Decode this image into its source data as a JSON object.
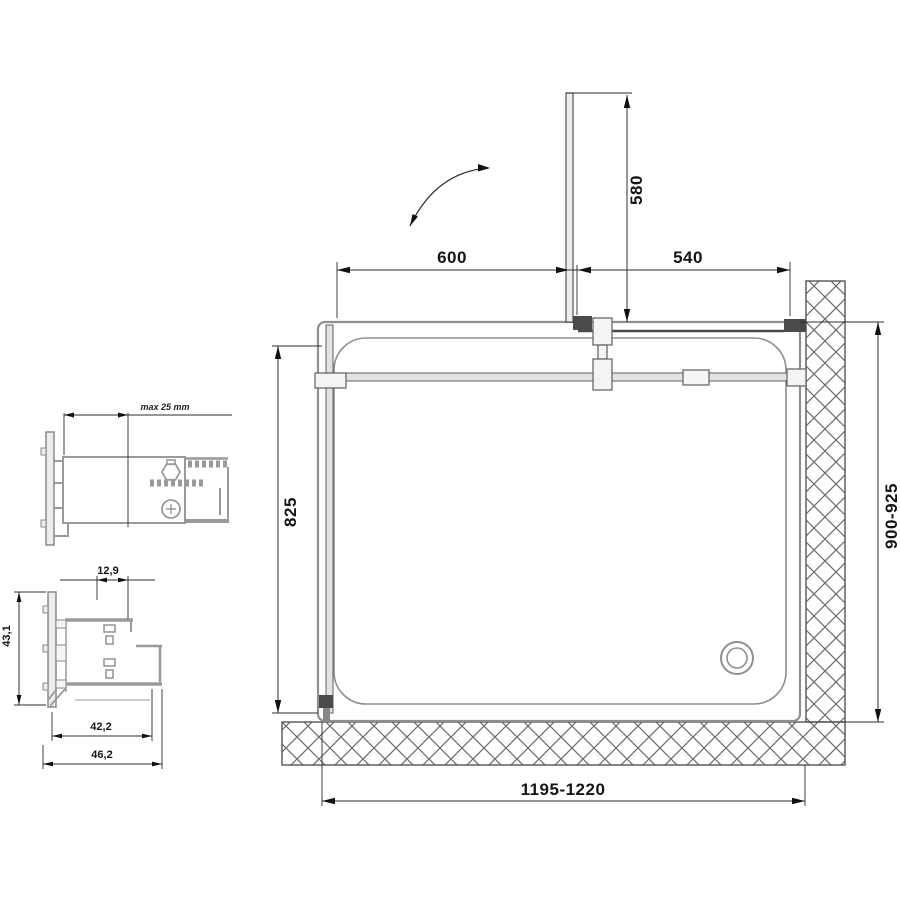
{
  "meta": {
    "type": "technical-drawing",
    "subject": "shower enclosure plan view with wall and floor profile details"
  },
  "colors": {
    "background": "#ffffff",
    "dimension_line": "#2e2e2e",
    "dimension_text": "#141414",
    "structure_gray": "#8f8f8f",
    "profile_gray": "#9a9a9a",
    "dark_accent": "#4a4a4a",
    "glass_fill": "#e3e3e3",
    "hatch_line": "#6b6b6b"
  },
  "plan": {
    "dim_top_left": "600",
    "dim_top_right": "540",
    "dim_door": "580",
    "dim_left_height": "825",
    "dim_right_height": "900-925",
    "dim_bottom_width": "1195-1220"
  },
  "detail_top": {
    "dim_adjustment": "max 25 mm"
  },
  "detail_bottom": {
    "dim_top": "12,9",
    "dim_left": "43,1",
    "dim_inner": "42,2",
    "dim_outer": "46,2"
  }
}
